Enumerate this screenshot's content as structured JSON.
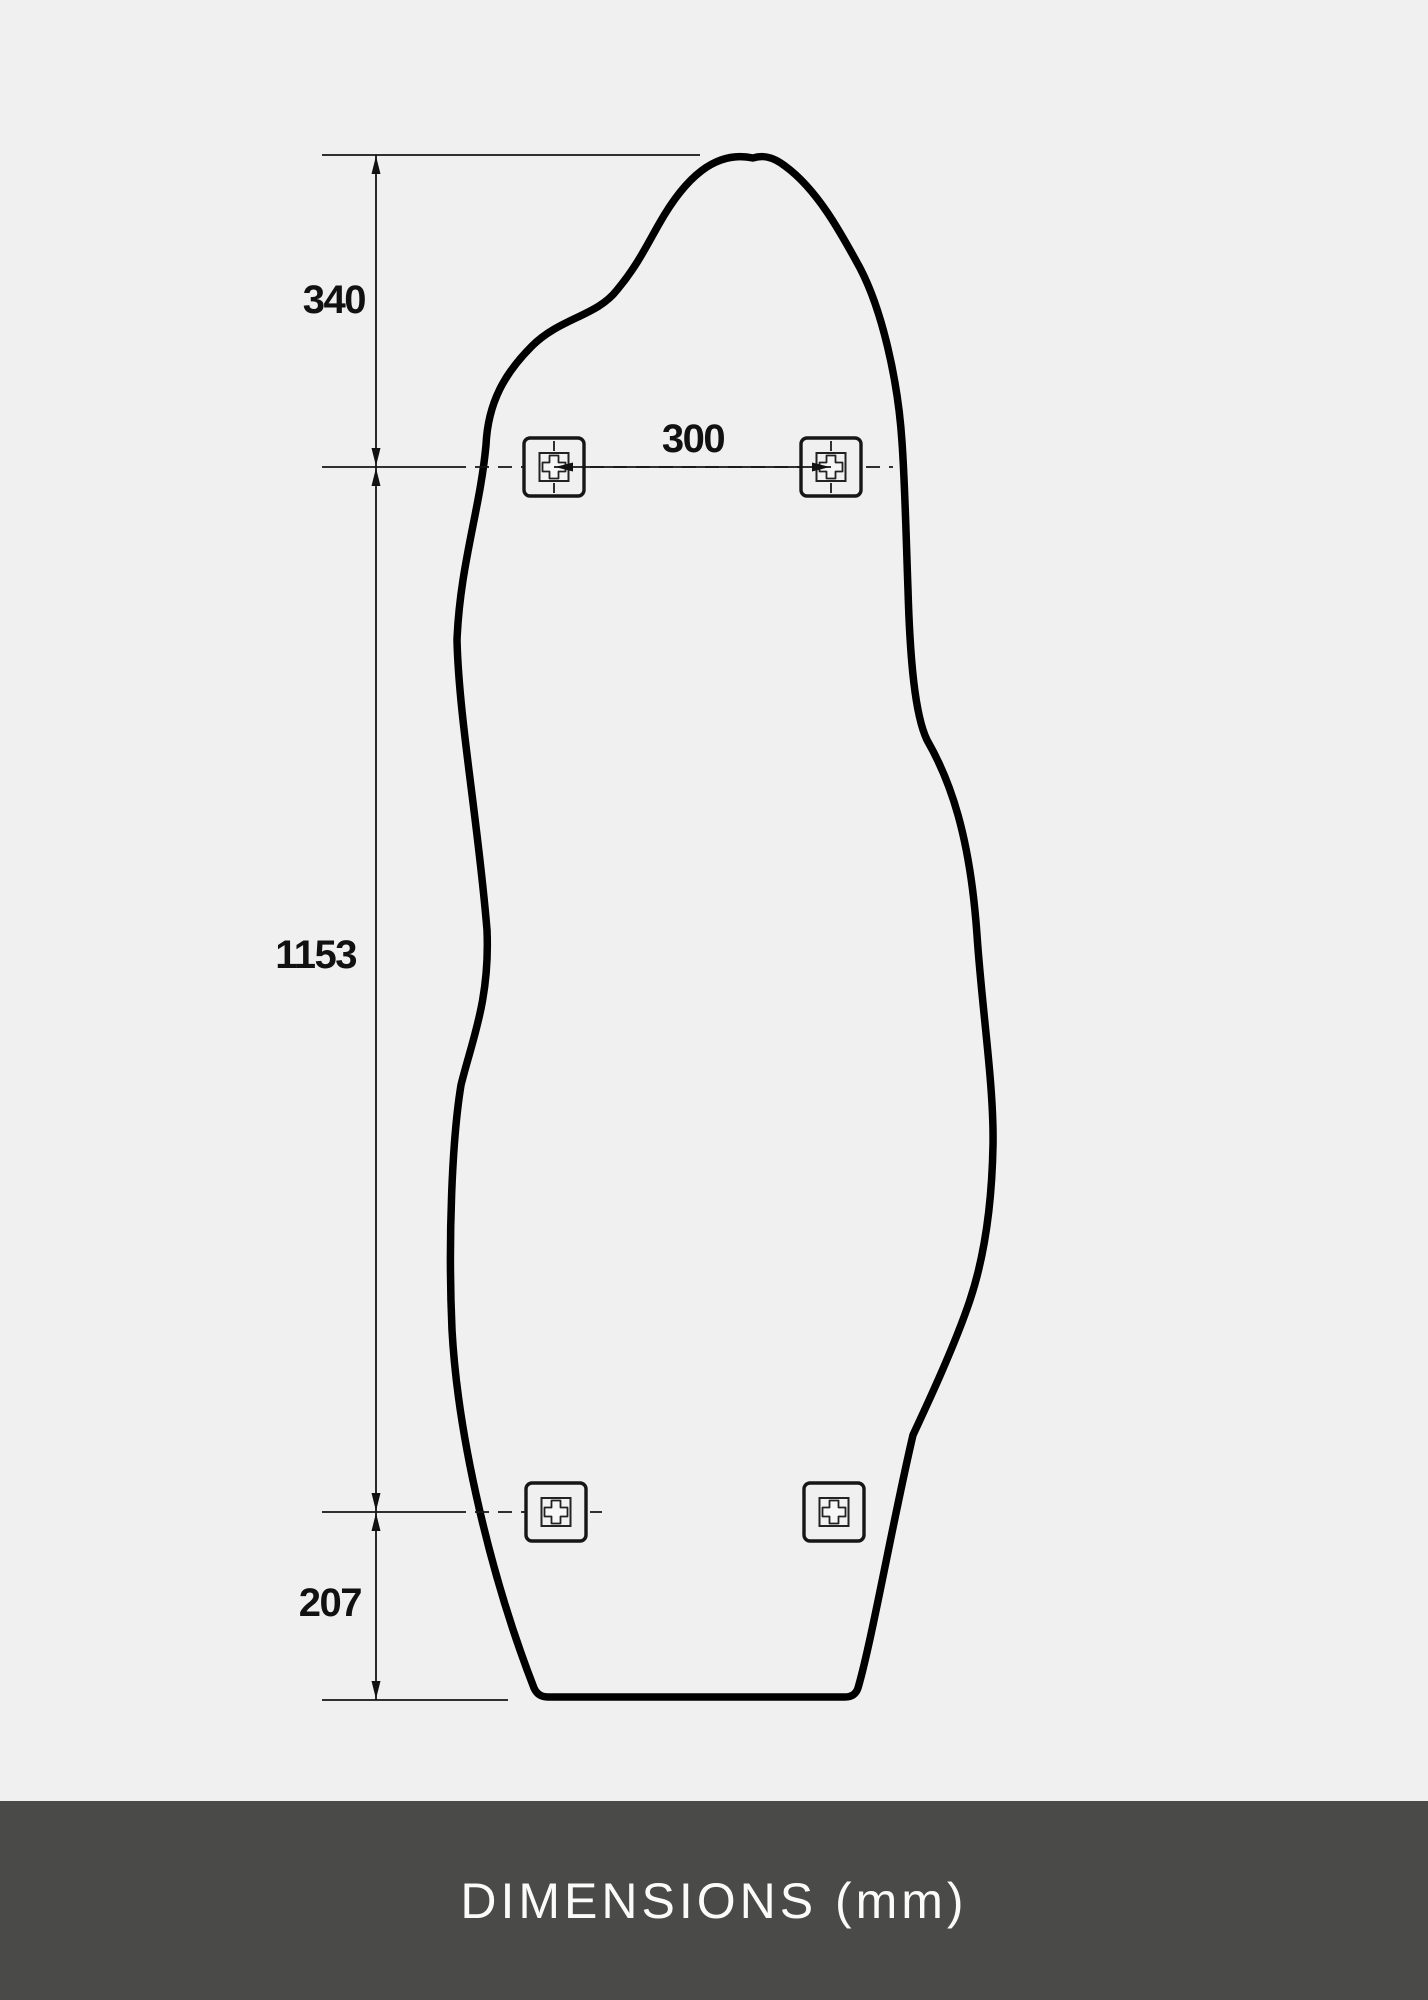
{
  "diagram": {
    "type": "technical-dimension-drawing",
    "subject": "irregular-organic-shaped-mirror-rear-view",
    "units": "mm",
    "dimensions": {
      "top_to_upper_holes": "340",
      "upper_hole_spacing": "300",
      "upper_to_lower_holes": "1153",
      "lower_holes_to_bottom": "207"
    },
    "icons": {
      "mount_bracket": "mount-bracket-icon",
      "arrowhead": "dimension-arrowhead-icon"
    },
    "colors": {
      "page_background": "#f0f0f0",
      "outline": "#000000",
      "dimension_lines": "#141414",
      "dimension_text": "#111111"
    }
  },
  "footer": {
    "caption": "DIMENSIONS (mm)",
    "colors": {
      "background": "#4a4a49",
      "text": "#fbfbfb"
    }
  }
}
